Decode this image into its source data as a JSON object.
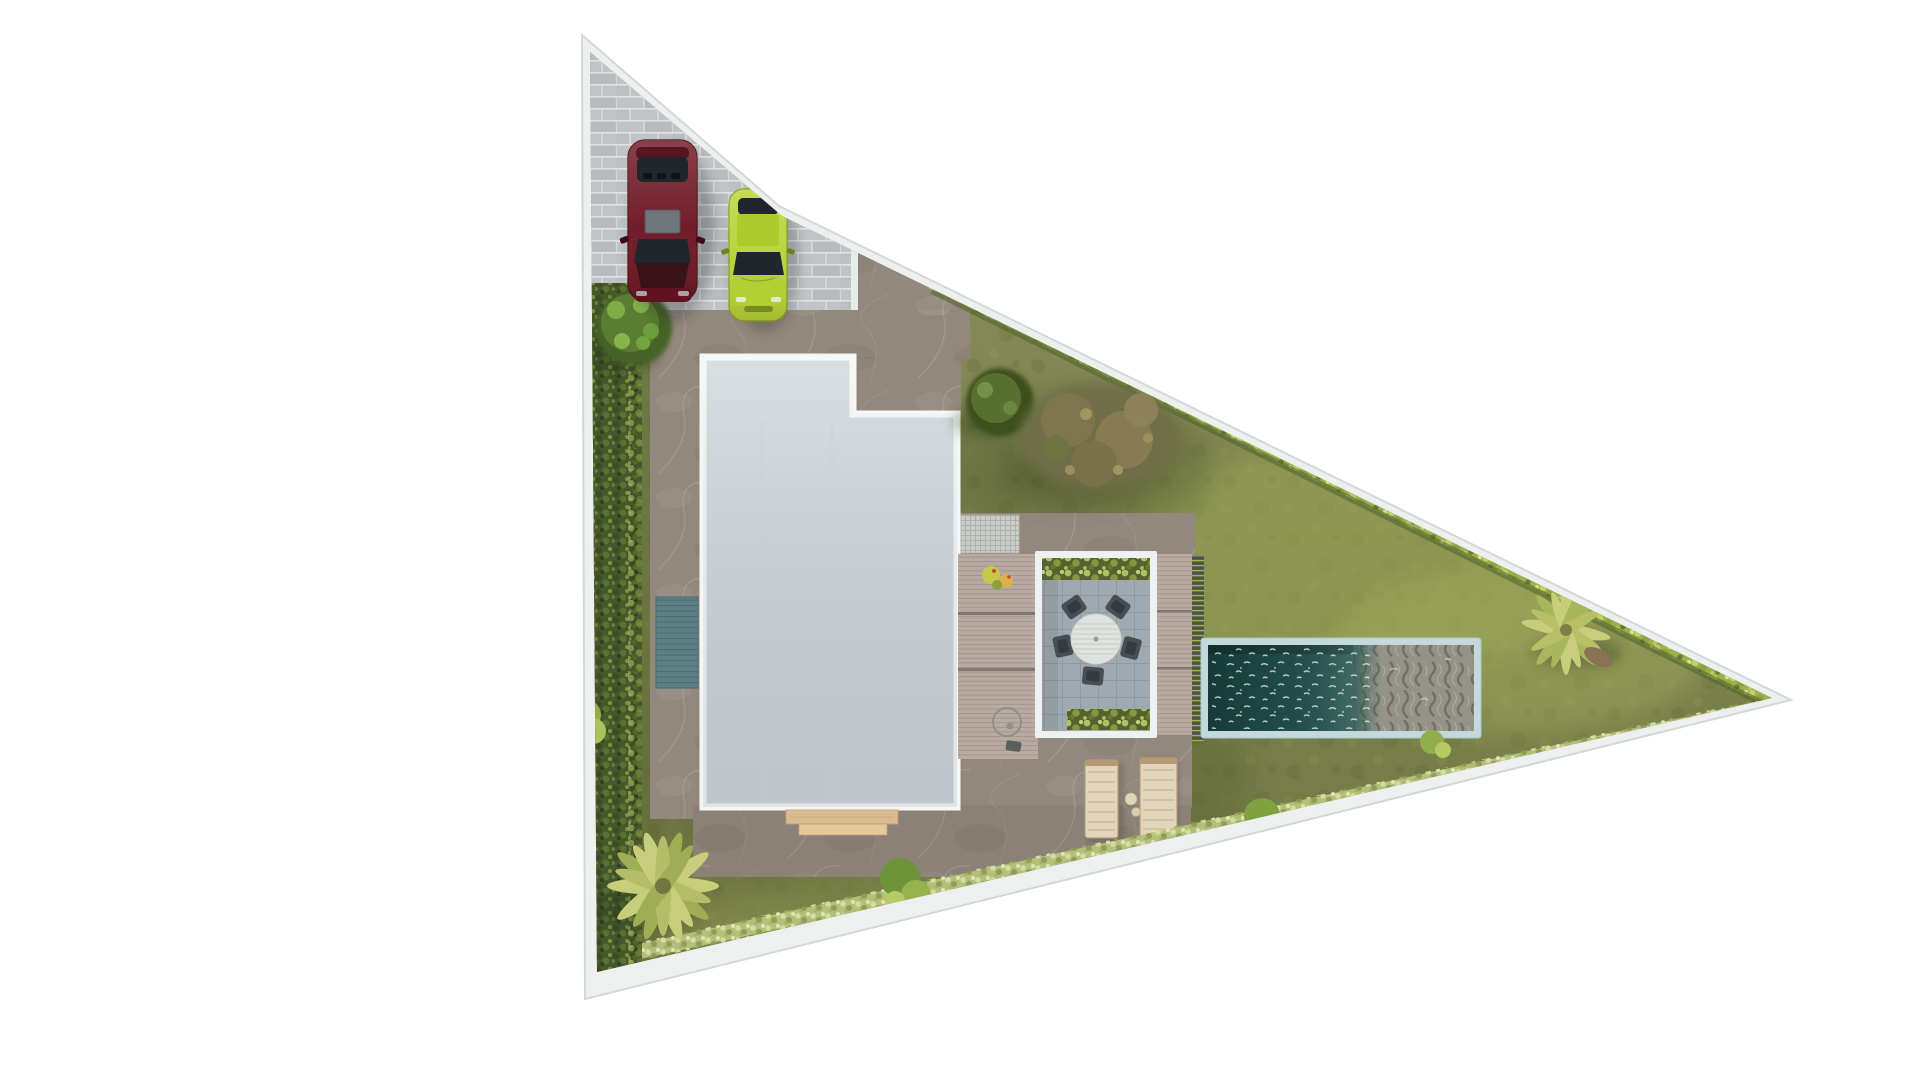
{
  "page": {
    "title": "Villa site plan - top view architectural render",
    "background": "#ffffff"
  },
  "scene": {
    "plot": {
      "shape": "right triangle with apex pointing east",
      "boundary": "white perimeter wall",
      "ground": "olive lawn"
    },
    "driveway": {
      "material": "grey block pavers",
      "vehicles": [
        {
          "label": "dark-red sedan",
          "color_key": "car_red"
        },
        {
          "label": "lime-green hatchback",
          "color_key": "car_green"
        }
      ]
    },
    "house": {
      "roof": "flat light-grey concrete slab with white parapet",
      "notch": "north-east corner step",
      "entry_steps": "timber steps on south side"
    },
    "hardscape": {
      "walkway": "taupe marble tile walkways",
      "water_runnel": "teal reflecting strip on west walkway",
      "louvre_canopy": "slatted canopy panel at courtyard",
      "deck": "timber deck with shower ring and 2 potted plants"
    },
    "dining": {
      "table": "round slatted white table",
      "chairs": 5,
      "planters": 2
    },
    "pool": {
      "type": "lap pool",
      "water": "dark teal with sparkle",
      "feature": "wave-relief carved stone shallow bed",
      "coping": "pale blue stone"
    },
    "loungers": {
      "count": 2,
      "material": "light timber",
      "side_tables": 2
    },
    "vegetation": [
      "west boundary hedge",
      "north-east boundary shrub hedge",
      "south grass fringe",
      "conifer beside driveway",
      "dark shrub tree",
      "large olive tree",
      "palm south-west",
      "palm near east apex",
      "bushes and rocks along south edge"
    ]
  },
  "colors": {
    "background": "#ffffff",
    "wall": "#eef0ef",
    "brick": "#c0c4c6",
    "marble": "#93887d",
    "roof": "#cfd6da",
    "roof_border": "#f5f7f7",
    "grass": "#7c8248",
    "hedge_dark": "#46572c",
    "hedge_bright": "#9db04b",
    "fringe": "#b7c27c",
    "runnel": "#5d8084",
    "pool_coping": "#c4d9db",
    "pool_water": "#234f4b",
    "wave_stone": "#95928a",
    "deck": "#b6aaa1",
    "louver_roof": "#c9ccc7",
    "louver_screen": "#565f50",
    "tile": "#a0a9af",
    "frame": "#eff1f0",
    "planter": "#55622f",
    "table": "#e0e2df",
    "chair": "#474f54",
    "lounger": "#e2d5bb",
    "step": "#d9bb8d",
    "car_red": "#6e1824",
    "car_green": "#b8d336",
    "glass": "#20262c",
    "sunroof": "#70757a",
    "tree_green": "#456325",
    "tree_dark": "#3c501f",
    "tree_olive": "#6f6e48",
    "palm": "#c6cd7b",
    "bush": "#8fae49",
    "rock": "#7a684e"
  }
}
